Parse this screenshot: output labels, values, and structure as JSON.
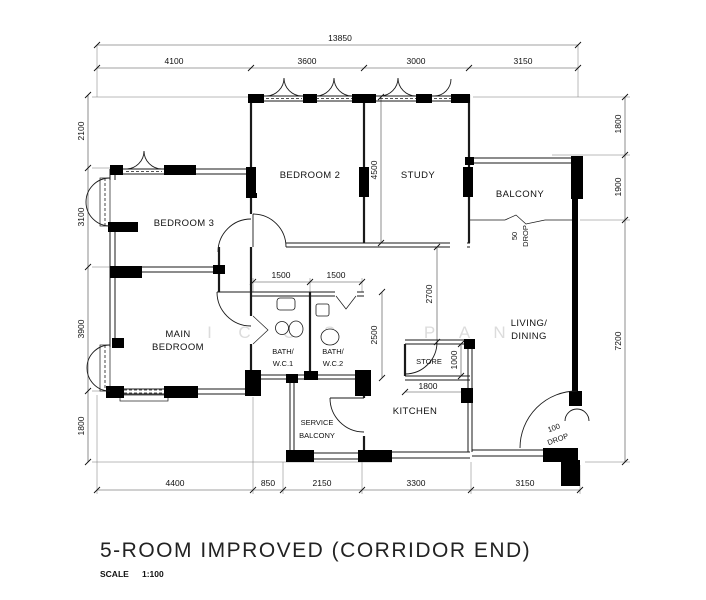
{
  "drawing": {
    "title": "5-ROOM IMPROVED (CORRIDOR END)",
    "scale_label": "SCALE",
    "scale_value": "1:100"
  },
  "rooms": {
    "bedroom2": "BEDROOM 2",
    "study": "STUDY",
    "balcony": "BALCONY",
    "bedroom3": "BEDROOM 3",
    "main1": "MAIN",
    "main2": "BEDROOM",
    "bath1a": "BATH/",
    "bath1b": "W.C.1",
    "bath2a": "BATH/",
    "bath2b": "W.C.2",
    "store": "STORE",
    "kitchen": "KITCHEN",
    "svc1": "SERVICE",
    "svc2": "BALCONY",
    "living1": "LIVING/",
    "living2": "DINING"
  },
  "dims": {
    "overall": "13850",
    "top": [
      "4100",
      "3600",
      "3000",
      "3150"
    ],
    "left": [
      "2100",
      "3100",
      "3900",
      "1800"
    ],
    "right": [
      "1800",
      "1900",
      "7200"
    ],
    "bottom": [
      "4400",
      "850",
      "2150",
      "3300",
      "3150"
    ],
    "bath1_w": "1500",
    "bath2_w": "1500",
    "bath_d": "2500",
    "bed2_d": "4500",
    "living_w": "2700",
    "store_h": "1000",
    "store_w": "1800"
  },
  "annotations": {
    "balcony_drop": [
      "50",
      "DROP"
    ],
    "entry_drop": [
      "100",
      "DROP"
    ]
  },
  "watermark": [
    "I",
    "C",
    "O",
    "S",
    "P",
    "A",
    "N"
  ]
}
